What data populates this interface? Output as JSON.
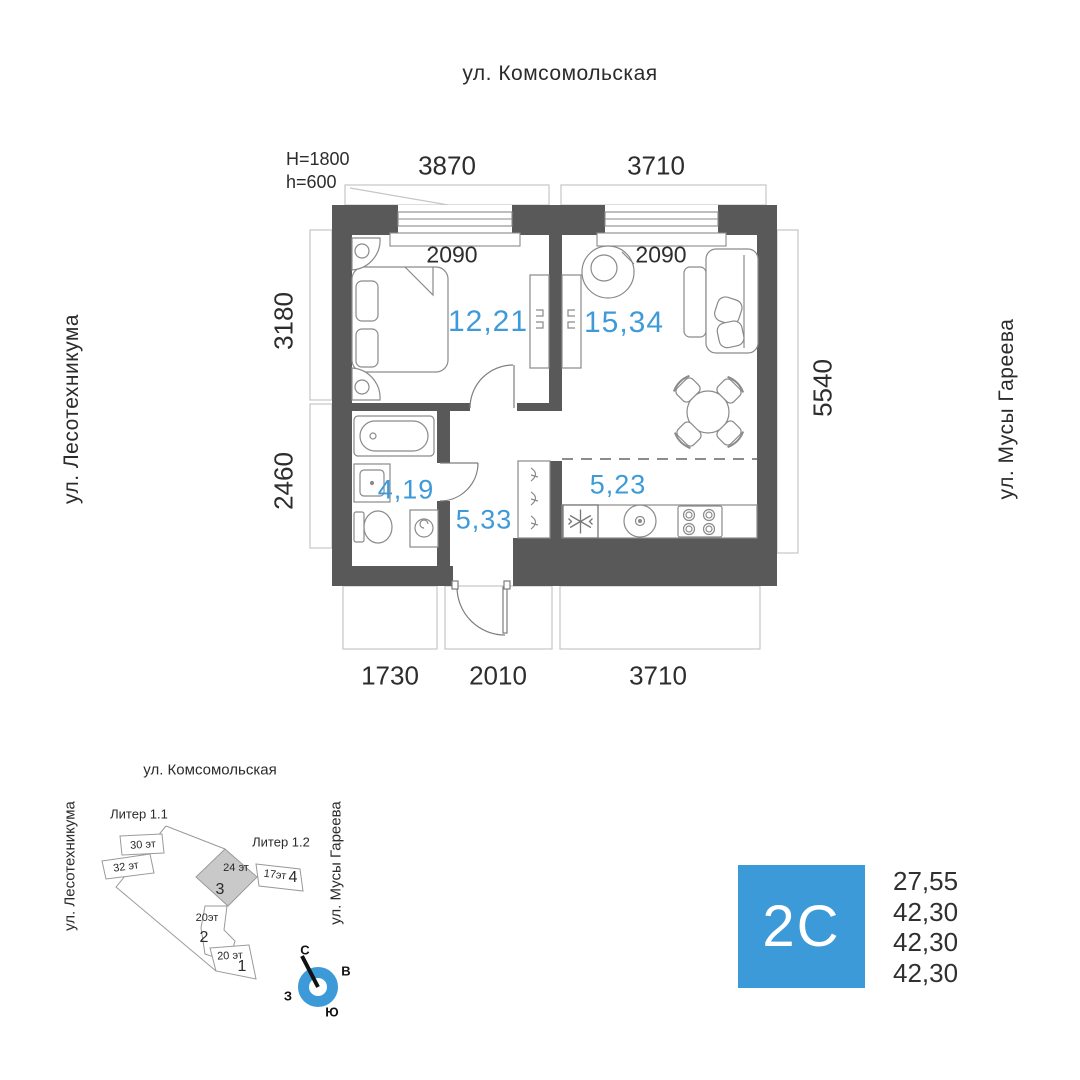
{
  "streets": {
    "top": "ул. Комсомольская",
    "left": "ул. Лесотехникума",
    "right": "ул. Мусы Гареева"
  },
  "plan": {
    "window_note_line1": "H=1800",
    "window_note_line2": "h=600",
    "dims": {
      "top1": "3870",
      "top2": "3710",
      "win1": "2090",
      "win2": "2090",
      "left1": "3180",
      "left2": "2460",
      "right1": "5540",
      "bottom1": "1730",
      "bottom2": "2010",
      "bottom3": "3710"
    },
    "rooms": {
      "bedroom_area": "12,21",
      "living_area": "15,34",
      "bathroom_area": "4,19",
      "hallway_area": "5,33",
      "kitchen_area": "5,23"
    }
  },
  "minimap": {
    "street_top": "ул. Комсомольская",
    "street_left": "ул. Лесотехникума",
    "street_right": "ул. Мусы Гареева",
    "liter1": "Литер 1.1",
    "liter2": "Литер 1.2",
    "buildings": {
      "b30": "30 эт",
      "b32": "32 эт",
      "b24": "24 эт",
      "n3": "3",
      "b17": "17эт",
      "n4": "4",
      "b20a": "20эт",
      "n2": "2",
      "b20b": "20 эт",
      "n1": "1"
    },
    "compass": {
      "n": "С",
      "e": "В",
      "w": "З",
      "s": "Ю"
    }
  },
  "summary": {
    "type_label": "2С",
    "areas": [
      "27,55",
      "42,30",
      "42,30",
      "42,30"
    ]
  },
  "colors": {
    "accent": "#3B9AD7",
    "wall": "#595959",
    "area_text": "#3E9AD8"
  }
}
